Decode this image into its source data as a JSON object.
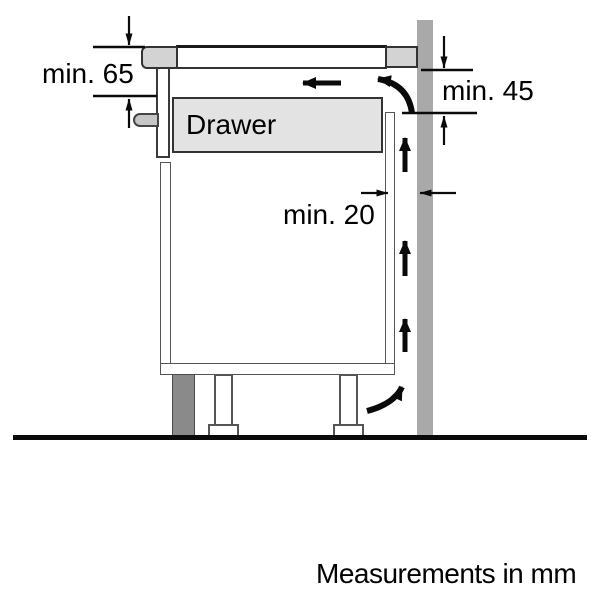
{
  "diagram": {
    "labels": {
      "min65": "min. 65",
      "min45": "min. 45",
      "min20": "min. 20",
      "drawer": "Drawer",
      "footer": "Measurements in mm"
    },
    "colors": {
      "background": "#ffffff",
      "outline": "#333333",
      "wall_gray": "#a9a9a9",
      "plinth_gray": "#8a8a8a",
      "drawer_fill": "#e3e3e3",
      "hob_trim_fill": "#d3d3d3",
      "handle_fill": "#c6c6c6",
      "arrow_black": "#0a0a0a"
    }
  }
}
